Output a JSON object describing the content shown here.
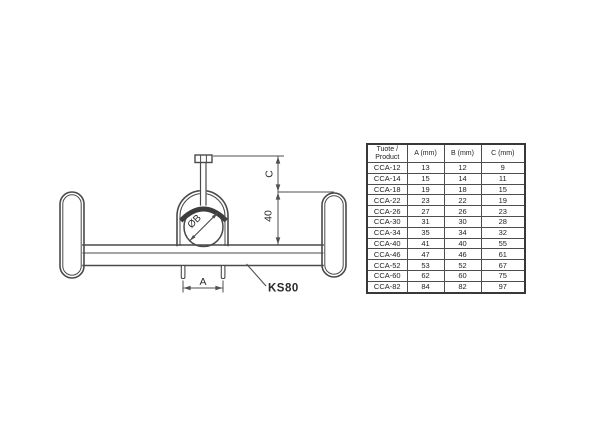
{
  "drawing": {
    "dim_c_label": "C",
    "dim_40_label": "40",
    "dim_a_label": "A",
    "cable_diameter_label": "ØB",
    "rail_label": "KS80"
  },
  "table": {
    "headers": {
      "product_line1": "Tuote /",
      "product_line2": "Product",
      "a": "A (mm)",
      "b": "B (mm)",
      "c": "C (mm)"
    },
    "rows": [
      {
        "product": "CCA-12",
        "a": "13",
        "b": "12",
        "c": "9"
      },
      {
        "product": "CCA-14",
        "a": "15",
        "b": "14",
        "c": "11"
      },
      {
        "product": "CCA-18",
        "a": "19",
        "b": "18",
        "c": "15"
      },
      {
        "product": "CCA-22",
        "a": "23",
        "b": "22",
        "c": "19"
      },
      {
        "product": "CCA-26",
        "a": "27",
        "b": "26",
        "c": "23"
      },
      {
        "product": "CCA-30",
        "a": "31",
        "b": "30",
        "c": "28"
      },
      {
        "product": "CCA-34",
        "a": "35",
        "b": "34",
        "c": "32"
      },
      {
        "product": "CCA-40",
        "a": "41",
        "b": "40",
        "c": "55"
      },
      {
        "product": "CCA-46",
        "a": "47",
        "b": "46",
        "c": "61"
      },
      {
        "product": "CCA-52",
        "a": "53",
        "b": "52",
        "c": "67"
      },
      {
        "product": "CCA-60",
        "a": "62",
        "b": "60",
        "c": "75"
      },
      {
        "product": "CCA-82",
        "a": "84",
        "b": "82",
        "c": "97"
      }
    ]
  },
  "colors": {
    "background": "#ffffff",
    "drawing_line": "#4a4a4a",
    "dimension_line": "#4f4f4f",
    "saddle_fill": "#3d3d3d",
    "text": "#2b2b2b",
    "table_border": "#383838"
  }
}
